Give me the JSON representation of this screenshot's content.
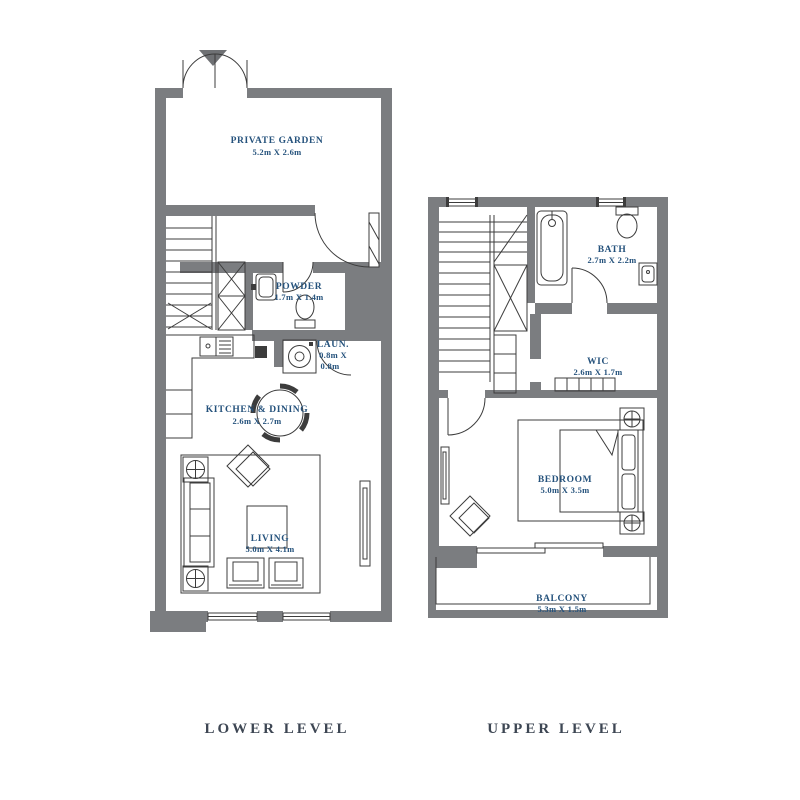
{
  "colors": {
    "wall": "#7b7d80",
    "line": "#3c3c3c",
    "room_label": "#25527c",
    "level_label": "#3d4653",
    "paper": "#ffffff"
  },
  "lower_level": {
    "title": "LOWER LEVEL",
    "rooms": {
      "private_garden": {
        "name": "PRIVATE GARDEN",
        "dims": "5.2m X 2.6m"
      },
      "powder": {
        "name": "POWDER",
        "dims": "1.7m X 1.4m"
      },
      "laundry": {
        "name": "LAUN.",
        "dims_line1": "0.8m X",
        "dims_line2": "0.8m"
      },
      "kitchen_dining": {
        "name": "KITCHEN & DINING",
        "dims": "2.6m X 2.7m"
      },
      "living": {
        "name": "LIVING",
        "dims": "5.0m X 4.1m"
      }
    }
  },
  "upper_level": {
    "title": "UPPER LEVEL",
    "rooms": {
      "bath": {
        "name": "BATH",
        "dims": "2.7m X 2.2m"
      },
      "wic": {
        "name": "WIC",
        "dims": "2.6m X 1.7m"
      },
      "bedroom": {
        "name": "BEDROOM",
        "dims": "5.0m X 3.5m"
      },
      "balcony": {
        "name": "BALCONY",
        "dims": "5.3m X 1.5m"
      }
    }
  }
}
